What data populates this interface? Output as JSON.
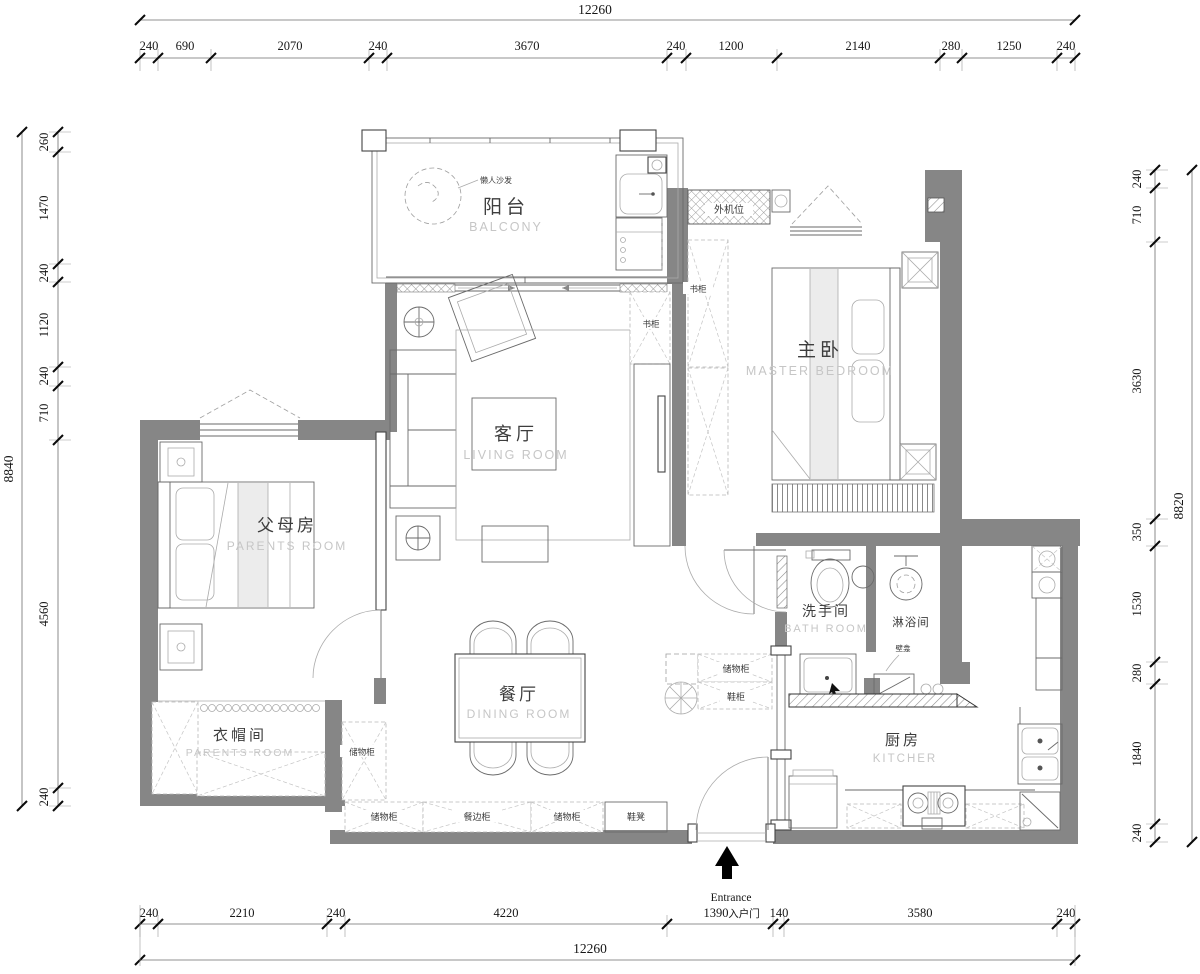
{
  "drawing": {
    "type": "apartment floor plan"
  },
  "colors": {
    "wall": "#868686",
    "cn_label": "#3d3d3d",
    "en_label": "#c6c6c6",
    "dim_text": "#161616"
  },
  "dims": {
    "top": {
      "total": "12260",
      "segments": [
        "240",
        "690",
        "2070",
        "240",
        "3670",
        "240",
        "1200",
        "2140",
        "280",
        "1250",
        "240"
      ]
    },
    "bottom": {
      "total": "12260",
      "segments": [
        "240",
        "2210",
        "240",
        "4220",
        "1390",
        "140",
        "3580",
        "240"
      ]
    },
    "left": {
      "total": "8840",
      "segments": [
        "260",
        "1470",
        "240",
        "1120",
        "240",
        "710",
        "4560",
        "240"
      ]
    },
    "right": {
      "total": "8820",
      "segments": [
        "240",
        "710",
        "3630",
        "350",
        "1530",
        "280",
        "1840",
        "240"
      ]
    }
  },
  "rooms": {
    "balcony": {
      "cn": "阳台",
      "en": "BALCONY"
    },
    "master": {
      "cn": "主卧",
      "en": "MASTER BEDROOM"
    },
    "living": {
      "cn": "客厅",
      "en": "LIVING ROOM"
    },
    "parents": {
      "cn": "父母房",
      "en": "PARENTS ROOM"
    },
    "bath": {
      "cn": "洗手间",
      "en": "BATH ROOM"
    },
    "shower": {
      "cn": "淋浴间"
    },
    "dining": {
      "cn": "餐厅",
      "en": "DINING ROOM"
    },
    "cloak": {
      "cn": "衣帽间",
      "en": "PARENTS ROOM"
    },
    "kitchen": {
      "cn": "厨房",
      "en": "KITCHER"
    }
  },
  "labels": {
    "lazy_sofa": "懒人沙发",
    "ac_platform": "外机位",
    "bookcase_master": "书柜",
    "bookcase_living": "书柜",
    "storage_entry": "储物柜",
    "shoe_cabinet": "鞋柜",
    "storage_side": "储物柜",
    "storage_bottom_left": "储物柜",
    "sideboard": "餐边柜",
    "storage_bottom_mid": "储物柜",
    "shoe_bench": "鞋凳",
    "niche": "壁龛"
  },
  "entrance": {
    "en": "Entrance",
    "cn": "入户门"
  }
}
